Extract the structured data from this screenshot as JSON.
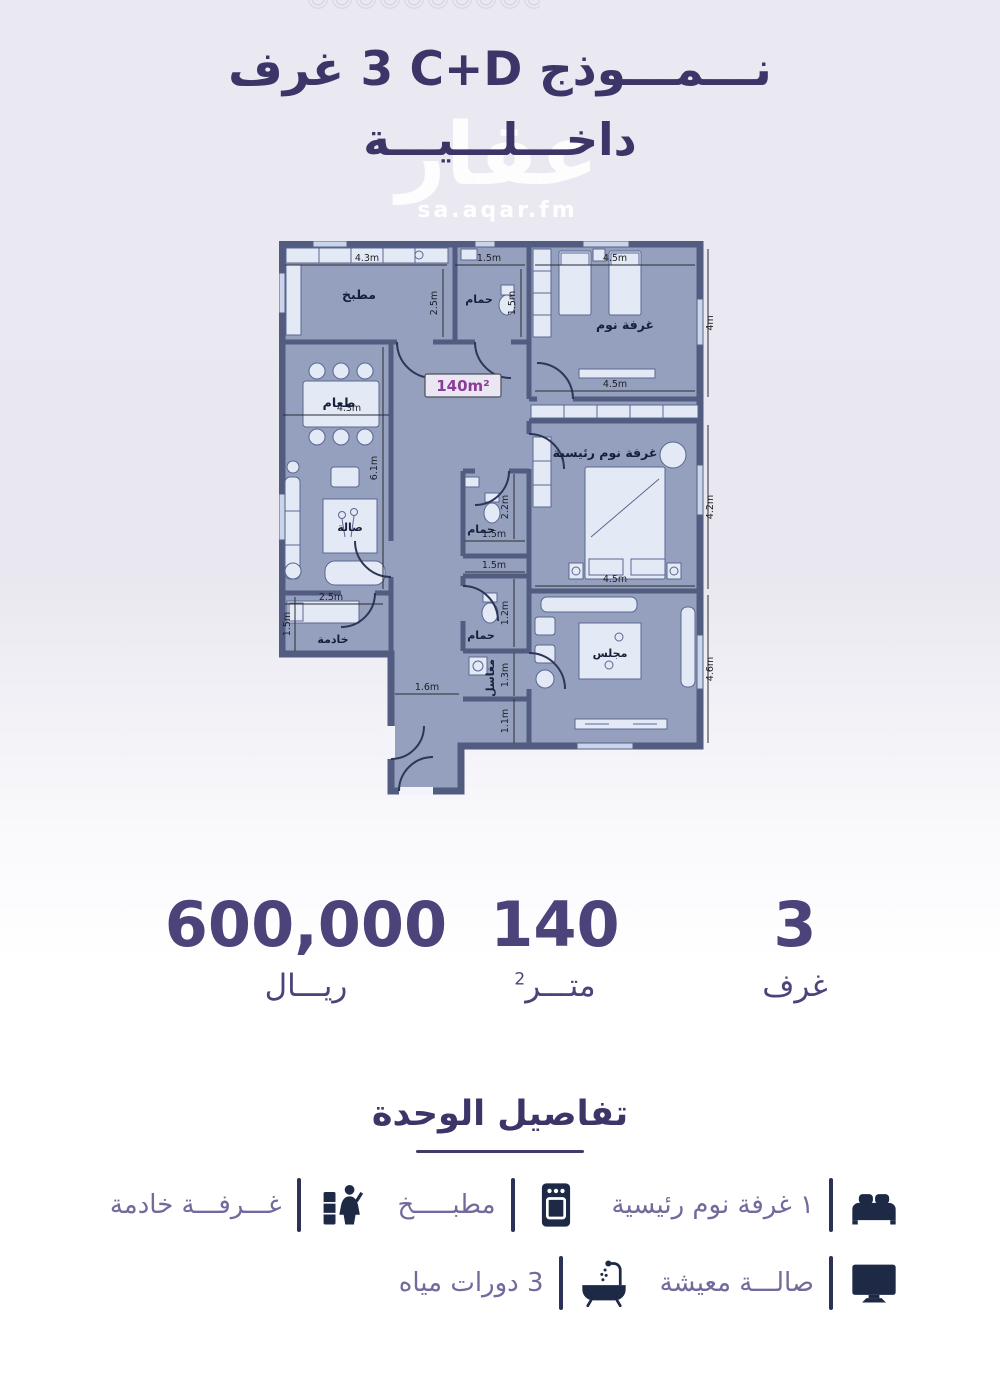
{
  "header": {
    "title_model": "نـــمـــوذج",
    "title_code": "C+D",
    "title_rooms": "3 غرف",
    "title_line2": "داخـــلـــيـــة",
    "watermark": "عقار",
    "watermark_sub": "sa.aqar.fm"
  },
  "plan": {
    "area_label": "140m²",
    "rooms": {
      "kitchen": "مطبخ",
      "bathroom": "حمام",
      "bedroom": "غرفة نوم",
      "master": "غرفة نوم رئيسية",
      "dining": "طعام",
      "living": "صالة",
      "maid": "خادمة",
      "majlis": "مجلس",
      "laundry": "مغاسل"
    },
    "dims": {
      "m43": "4.3m",
      "m45": "4.5m",
      "m15": "1.5m",
      "m25": "2.5m",
      "m4": "4m",
      "m61": "6.1m",
      "m42": "4.2m",
      "m22": "2.2m",
      "m12": "1.2m",
      "m13": "1.3m",
      "m16": "1.6m",
      "m11": "1.1m",
      "m46": "4.6m"
    }
  },
  "stats": {
    "price": {
      "value": "600,000",
      "label": "ريـــال"
    },
    "area": {
      "value": "140",
      "label": "متـــر",
      "sup": "2"
    },
    "rooms": {
      "value": "3",
      "label": "غرف"
    }
  },
  "details": {
    "heading": "تفاصيل الوحدة",
    "features": [
      {
        "icon": "bed-icon",
        "label": "١ غرفة نوم رئيسية"
      },
      {
        "icon": "oven-icon",
        "label": "مطبـــــخ"
      },
      {
        "icon": "maid-icon",
        "label": "غـــرفـــة خادمة"
      },
      {
        "icon": "tv-icon",
        "label": "صالـــة معيشة"
      },
      {
        "icon": "bathtub-icon",
        "label": "3 دورات مياه"
      }
    ]
  },
  "colors": {
    "background_top": "#eae9f1",
    "background_bottom": "#ffffff",
    "accent_purple": "#3c3568",
    "stat_purple": "#4b4379",
    "feature_text": "#706b9c",
    "icon_navy": "#1d2945",
    "plan_wall": "#515c80",
    "plan_floor": "#94a0bd",
    "area_label_purple": "#8a3d96"
  }
}
